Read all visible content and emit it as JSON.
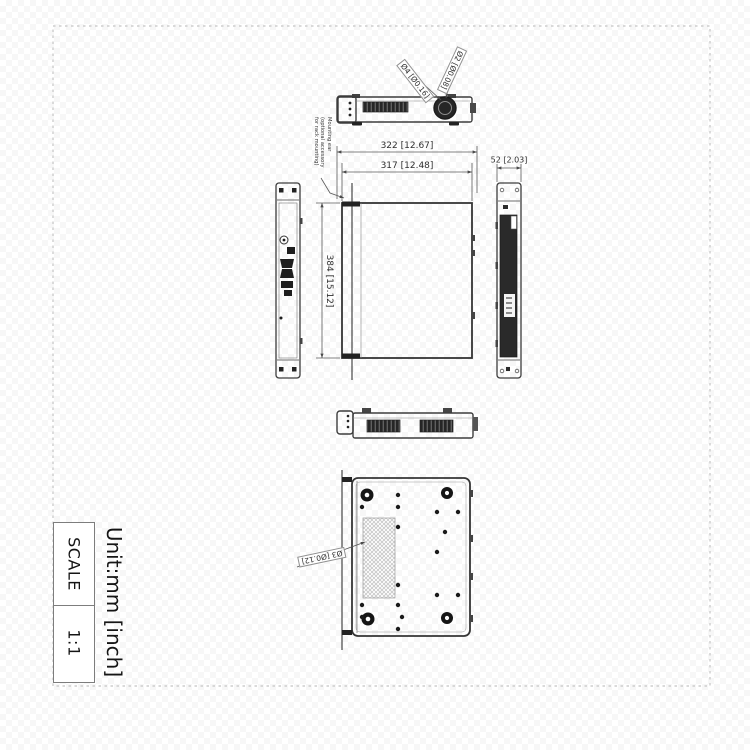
{
  "title_block": {
    "scale_label": "SCALE",
    "scale_value": "1:1",
    "unit_label": "Unit:mm [inch]"
  },
  "dimensions": {
    "overall_width": "322 [12.67]",
    "body_width": "317 [12.48]",
    "depth": "384 [15.12]",
    "side_width": "52 [2.03]",
    "knob_outer_dia": "Ø4 [Ø0.16]",
    "knob_inner_dia": "Ø2 [Ø0.08]",
    "bottom_hole_dia": "Ø3 [Ø0.12]"
  },
  "notes": {
    "mounting_ear": "Mounting ear (optional accessory for rack mounting)"
  }
}
